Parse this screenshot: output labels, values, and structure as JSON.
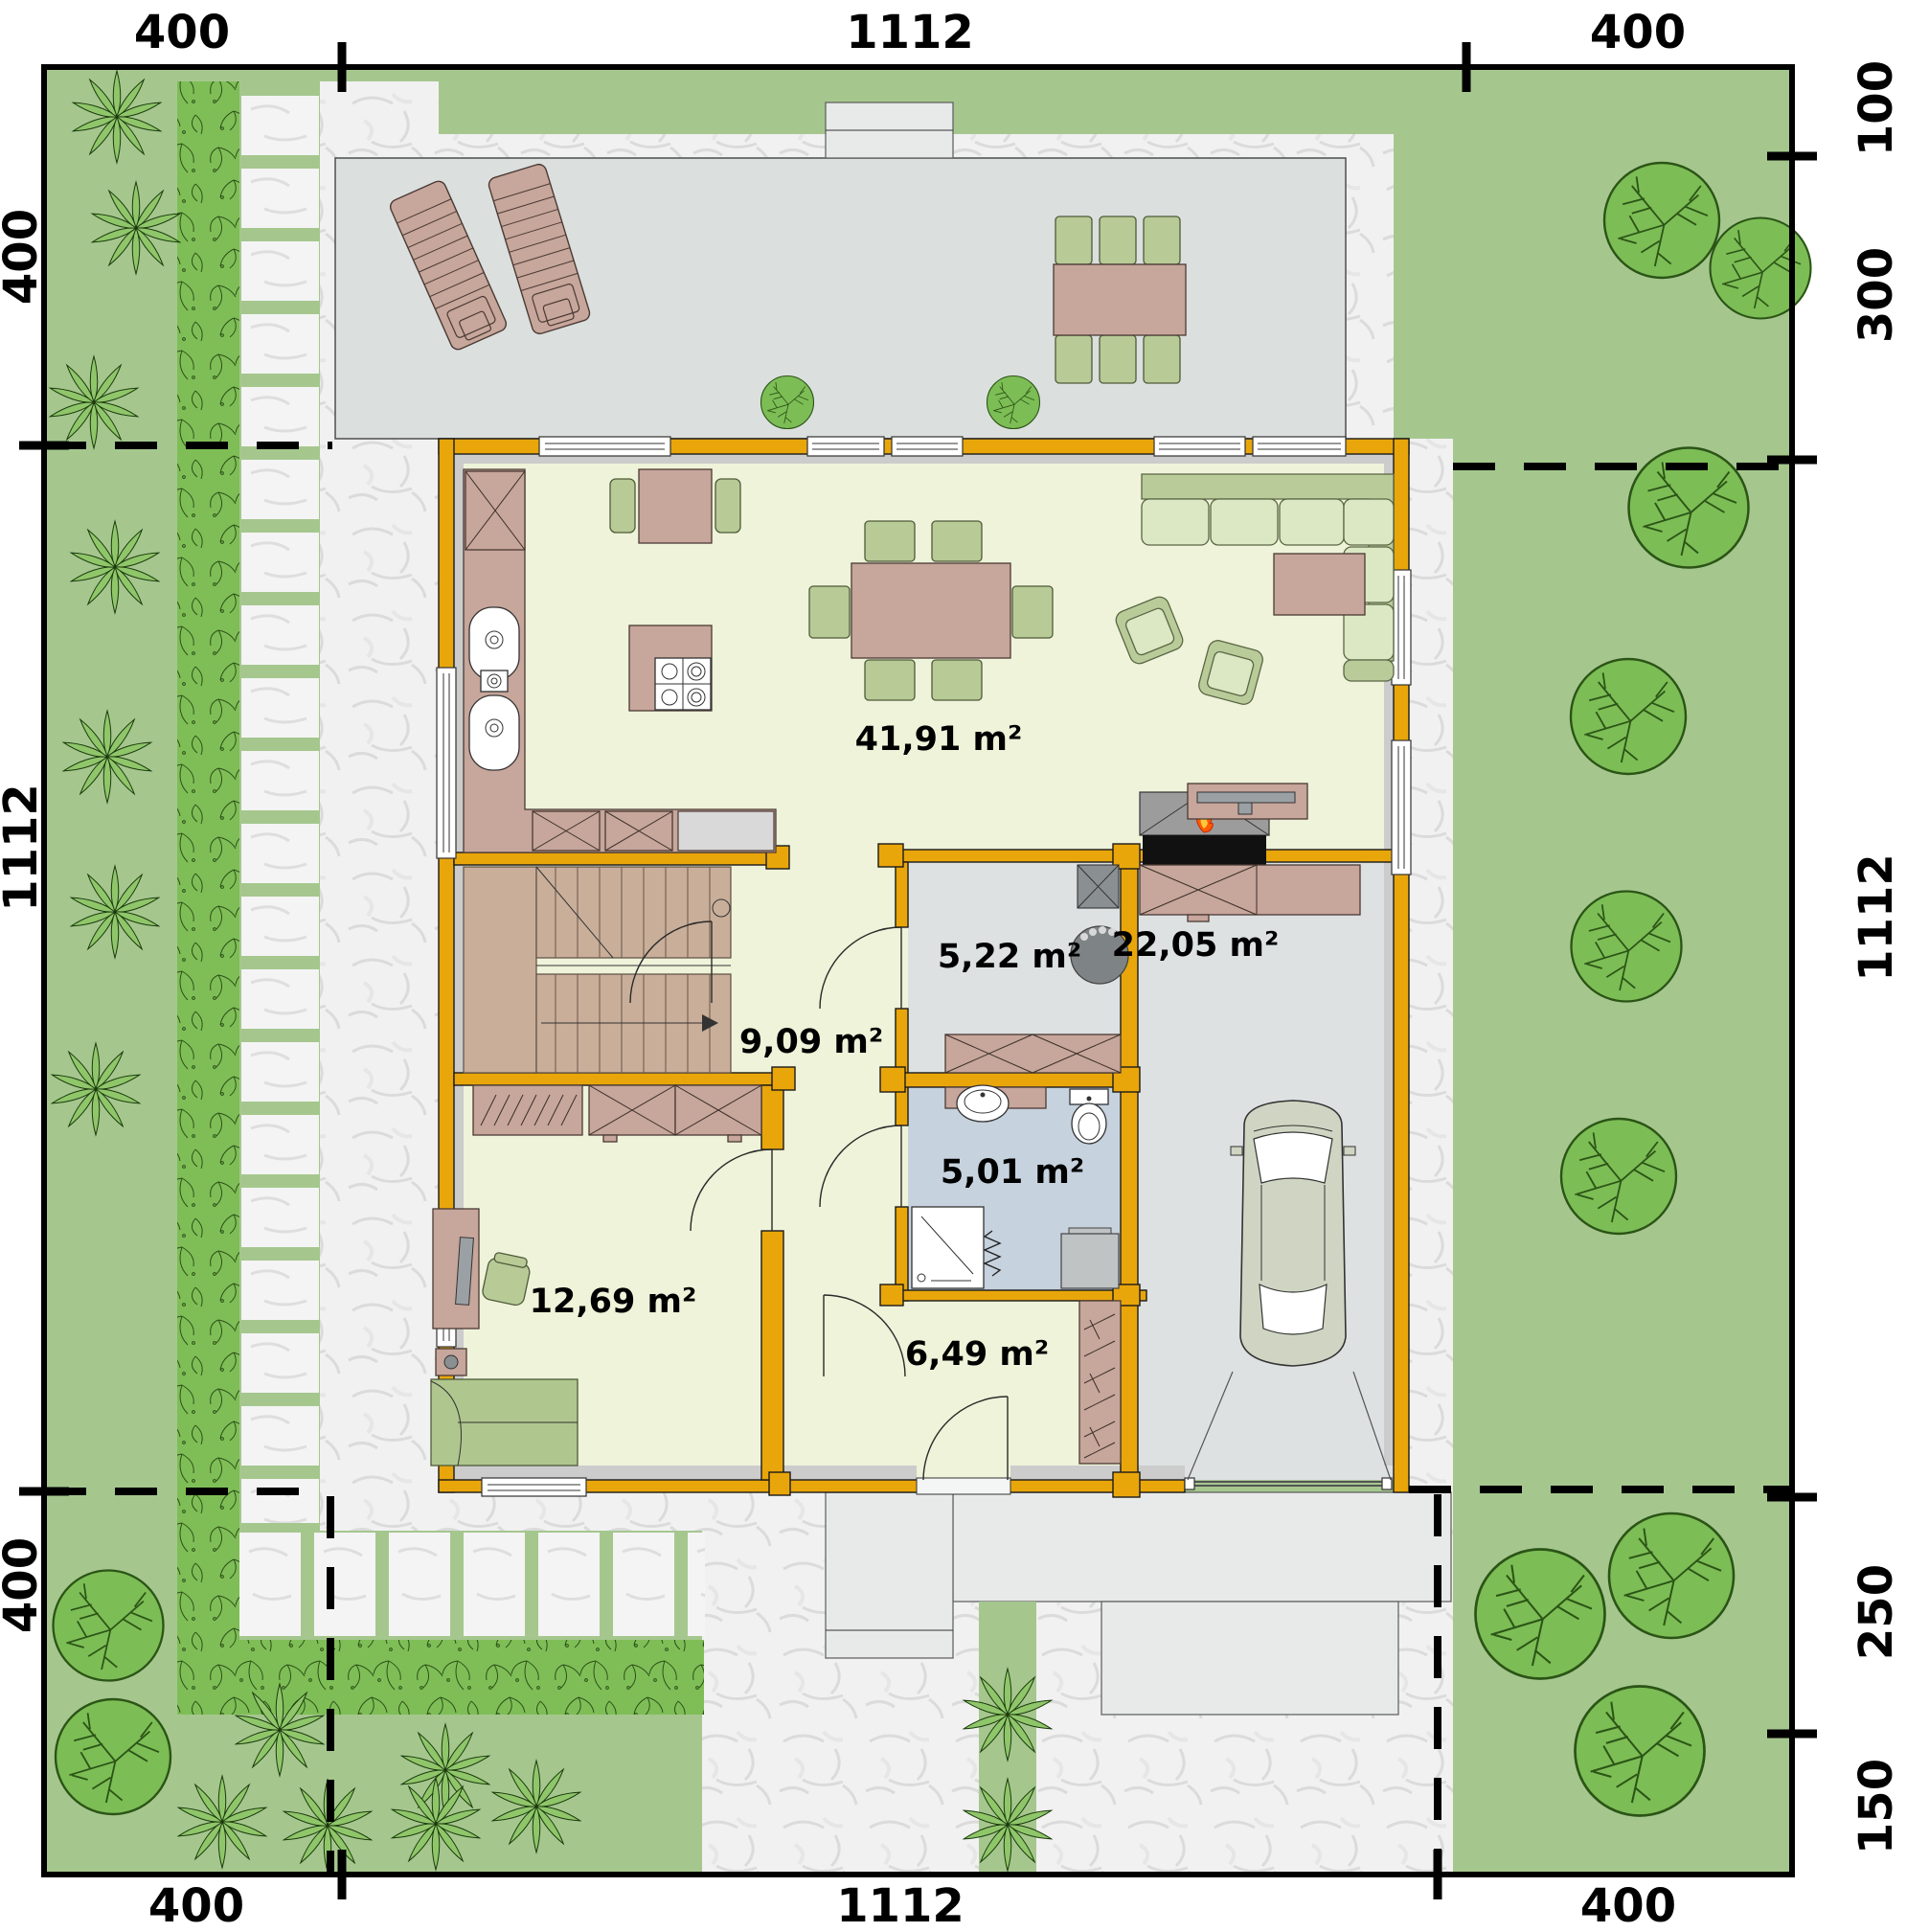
{
  "plan": {
    "title": "ground-floor site plan",
    "dimensions": {
      "top": [
        "400",
        "1112",
        "400"
      ],
      "bottom": [
        "400",
        "1112",
        "400"
      ],
      "left": [
        "400",
        "1112",
        "400"
      ],
      "right": [
        "100",
        "300",
        "1112",
        "250",
        "150"
      ]
    },
    "rooms": [
      {
        "name": "living-dining-kitchen",
        "area": "41,91 m²"
      },
      {
        "name": "utility-room",
        "area": "5,22 m²"
      },
      {
        "name": "garage",
        "area": "22,05 m²"
      },
      {
        "name": "hallway",
        "area": "9,09 m²"
      },
      {
        "name": "bathroom",
        "area": "5,01 m²"
      },
      {
        "name": "office",
        "area": "12,69 m²"
      },
      {
        "name": "entry",
        "area": "6,49 m²"
      }
    ],
    "colors": {
      "lawn": "#A5C78E",
      "hedge": "#7FBE57",
      "hedgeLine": "#2B5217",
      "gravel": "#F1F1F1",
      "gravelLine": "#DBDBDB",
      "stone": "#F4F4F4",
      "terrace": "#DBDFDE",
      "slab": "#E8EAEA",
      "wall": "#E9A60B",
      "lining": "#CCCCCC",
      "floor": "#EEF3D9",
      "floorGray": "#DDE1E2",
      "floorBath": "#C6D2DE",
      "brown": "#C7A69B",
      "brownDark": "#4A3A34",
      "stairs": "#C9AE99",
      "seatLight": "#DCE8C4",
      "seatDark": "#B9CB99",
      "seatStroke": "#5A6644",
      "chairGreen": "#B8CA96",
      "tree": "#7CBD55",
      "treeLine": "#2B5416",
      "palm": "#8FC66A",
      "car": "#CFD5C2",
      "fpGray": "#9C9C9C",
      "fpBlack": "#111111",
      "flame": "#FF5A00",
      "flameCore": "#FFC83D",
      "metal": "#9AA0A3",
      "boiler": "#BFC3C4",
      "heater": "#7E8486",
      "text": "#000000"
    }
  }
}
